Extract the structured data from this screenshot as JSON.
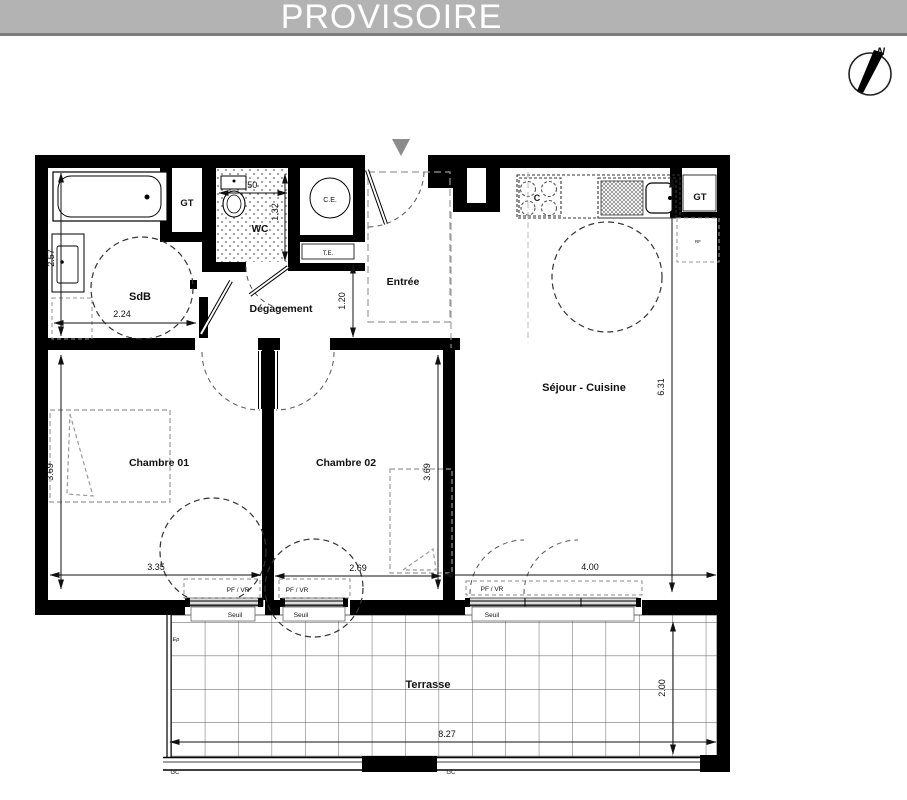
{
  "banner": {
    "title": "PROVISOIRE"
  },
  "compass": {
    "north_label": "N"
  },
  "rooms": {
    "sdb": "SdB",
    "wc": "WC",
    "degagement": "Dégagement",
    "entree": "Entrée",
    "sejour_cuisine": "Séjour - Cuisine",
    "chambre1": "Chambre 01",
    "chambre2": "Chambre 02",
    "terrasse": "Terrasse"
  },
  "equipment": {
    "gt_bathroom": "GT",
    "gt_sejour": "GT",
    "water_heater": "C.E.",
    "electrical_panel": "T.E.",
    "cooktop": "C",
    "fridge": "RF",
    "rain_drain": "Ep"
  },
  "dimensions": {
    "sdb_width": "2.24",
    "sdb_height": "2.57",
    "wc_width": ".50",
    "wc_height": "1.32",
    "hall_width": "1.20",
    "sejour_height": "6.31",
    "sejour_width": "4.00",
    "chambre1_height": "3.69",
    "chambre1_width": "3.35",
    "chambre2_height": "3.69",
    "chambre2_width": "2.69",
    "terrasse_width": "8.27",
    "terrasse_height": "2.00"
  },
  "windows": {
    "type_label": "PF / VR",
    "threshold_label": "Seuil",
    "gc_label": "GC"
  },
  "colors": {
    "banner_bg": "#b3b3b3",
    "banner_text": "#ffffff",
    "wall": "#000000",
    "entry_arrow": "#8c8c8c"
  }
}
